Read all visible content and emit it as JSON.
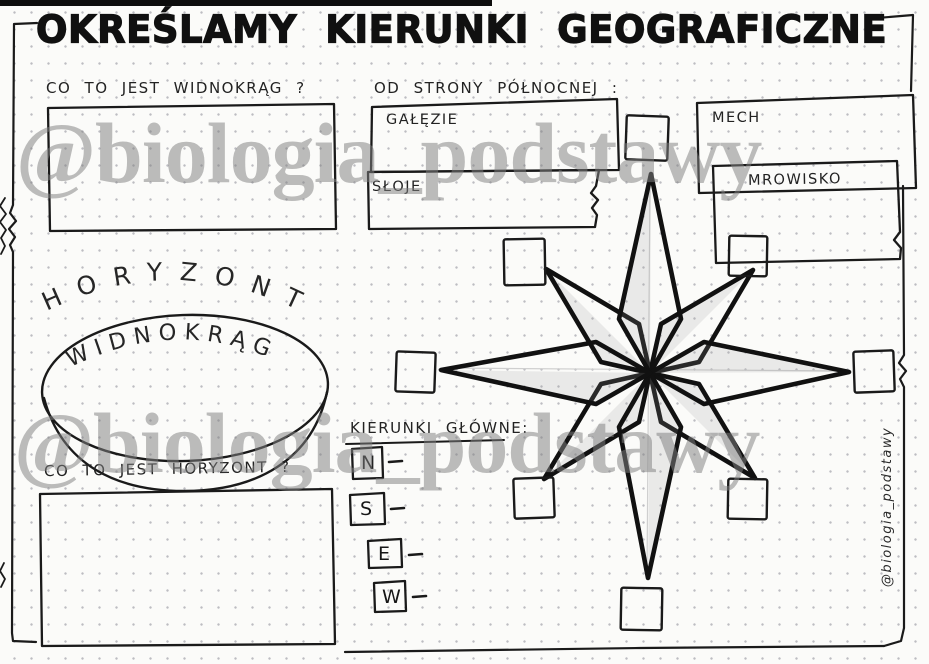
{
  "title": "OKREŚLAMY KIERUNKI GEOGRAFICZNE",
  "watermark": {
    "text": "@biologia_podstawy",
    "color": "rgba(128,128,128,0.52)"
  },
  "side_credit": "@biologia_podstawy",
  "horizon_section": {
    "question_top": "CO TO JEST WIDNOKRĄG ?",
    "arc_word": "HORYZONT",
    "disc_word": "WIDNOKRĄG",
    "question_bottom": "CO TO JEST HORYZONT ?"
  },
  "north_section": {
    "heading": "OD STRONY PÓŁNOCNEJ :",
    "items": [
      "GAŁĘZIE",
      "SŁOJE",
      "MECH",
      "MROWISKO"
    ]
  },
  "directions_section": {
    "heading": "KIERUNKI GŁÓWNE:",
    "letters": [
      "N",
      "S",
      "E",
      "W"
    ]
  },
  "colors": {
    "ink": "#1a1a1a",
    "pencil_shade": "#9a9a9a"
  }
}
